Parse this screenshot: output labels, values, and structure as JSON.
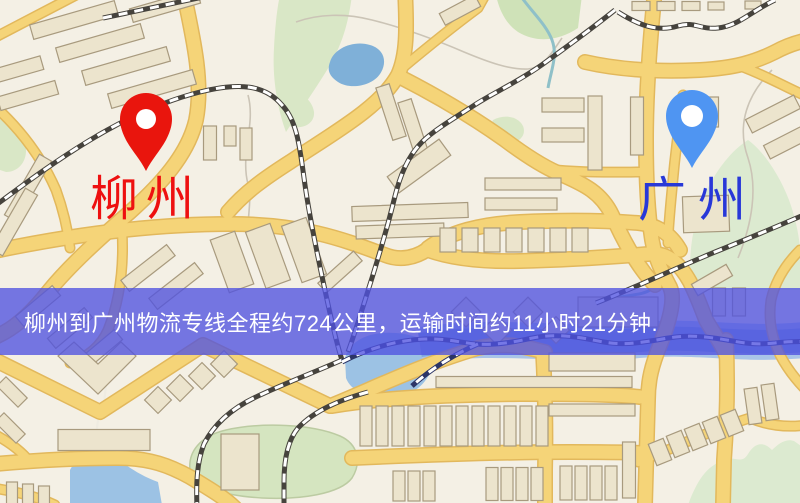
{
  "map": {
    "origin": {
      "name": "柳州"
    },
    "destination": {
      "name": "广州"
    },
    "info_banner": {
      "text": "柳州到广州物流专线全程约724公里，运输时间约11小时21分钟."
    },
    "route": {
      "distance_km": "724",
      "duration": "11小时21分钟"
    },
    "colors": {
      "origin_pin": "#e9150d",
      "origin_label": "#ee1010",
      "destination_pin": "#4f95f2",
      "destination_label": "#2838d8",
      "banner_bg": "rgba(80,82,224,0.78)",
      "banner_text": "#ffffff",
      "road": "#f5d478",
      "water": "#8fb9de",
      "park": "#d9e7c6",
      "railway": "#46433d"
    }
  }
}
